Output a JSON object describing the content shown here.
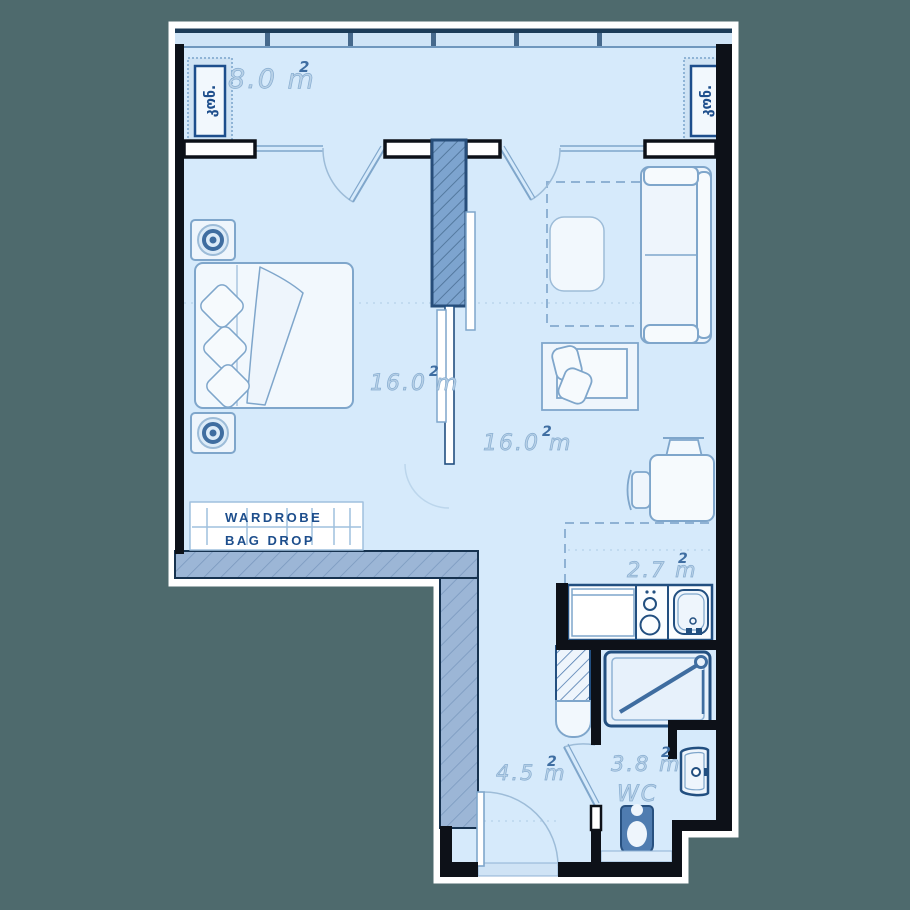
{
  "plan": {
    "title": "apartment-floor-plan",
    "balcony": {
      "area": "8.0 m",
      "area_sup": "2",
      "ac_left": "კონ.",
      "ac_right": "კონ."
    },
    "bedroom": {
      "area": "16.0 m",
      "area_sup": "2"
    },
    "living_room": {
      "area": "16.0 m",
      "area_sup": "2"
    },
    "kitchen": {
      "area": "2.7 m",
      "area_sup": "2"
    },
    "hallway": {
      "area": "4.5 m",
      "area_sup": "2"
    },
    "bathroom": {
      "area": "3.8 m",
      "area_sup": "2",
      "wc": "WC"
    },
    "wardrobe": {
      "line1": "WARDROBE",
      "line2": "BAG DROP"
    }
  },
  "colors": {
    "background": "#4e6a6d",
    "floor": "#d6eafb",
    "wall": "#0d1118",
    "wall_outline": "#ffffff",
    "hatch_wall_fill": "#9cb6d6",
    "hatch_column_fill": "#7da4cf",
    "accent_line": "#224f80",
    "furniture_line": "#7fa6cb",
    "label_text": "#b8d1e7",
    "dark_text": "#1d4e8c"
  }
}
